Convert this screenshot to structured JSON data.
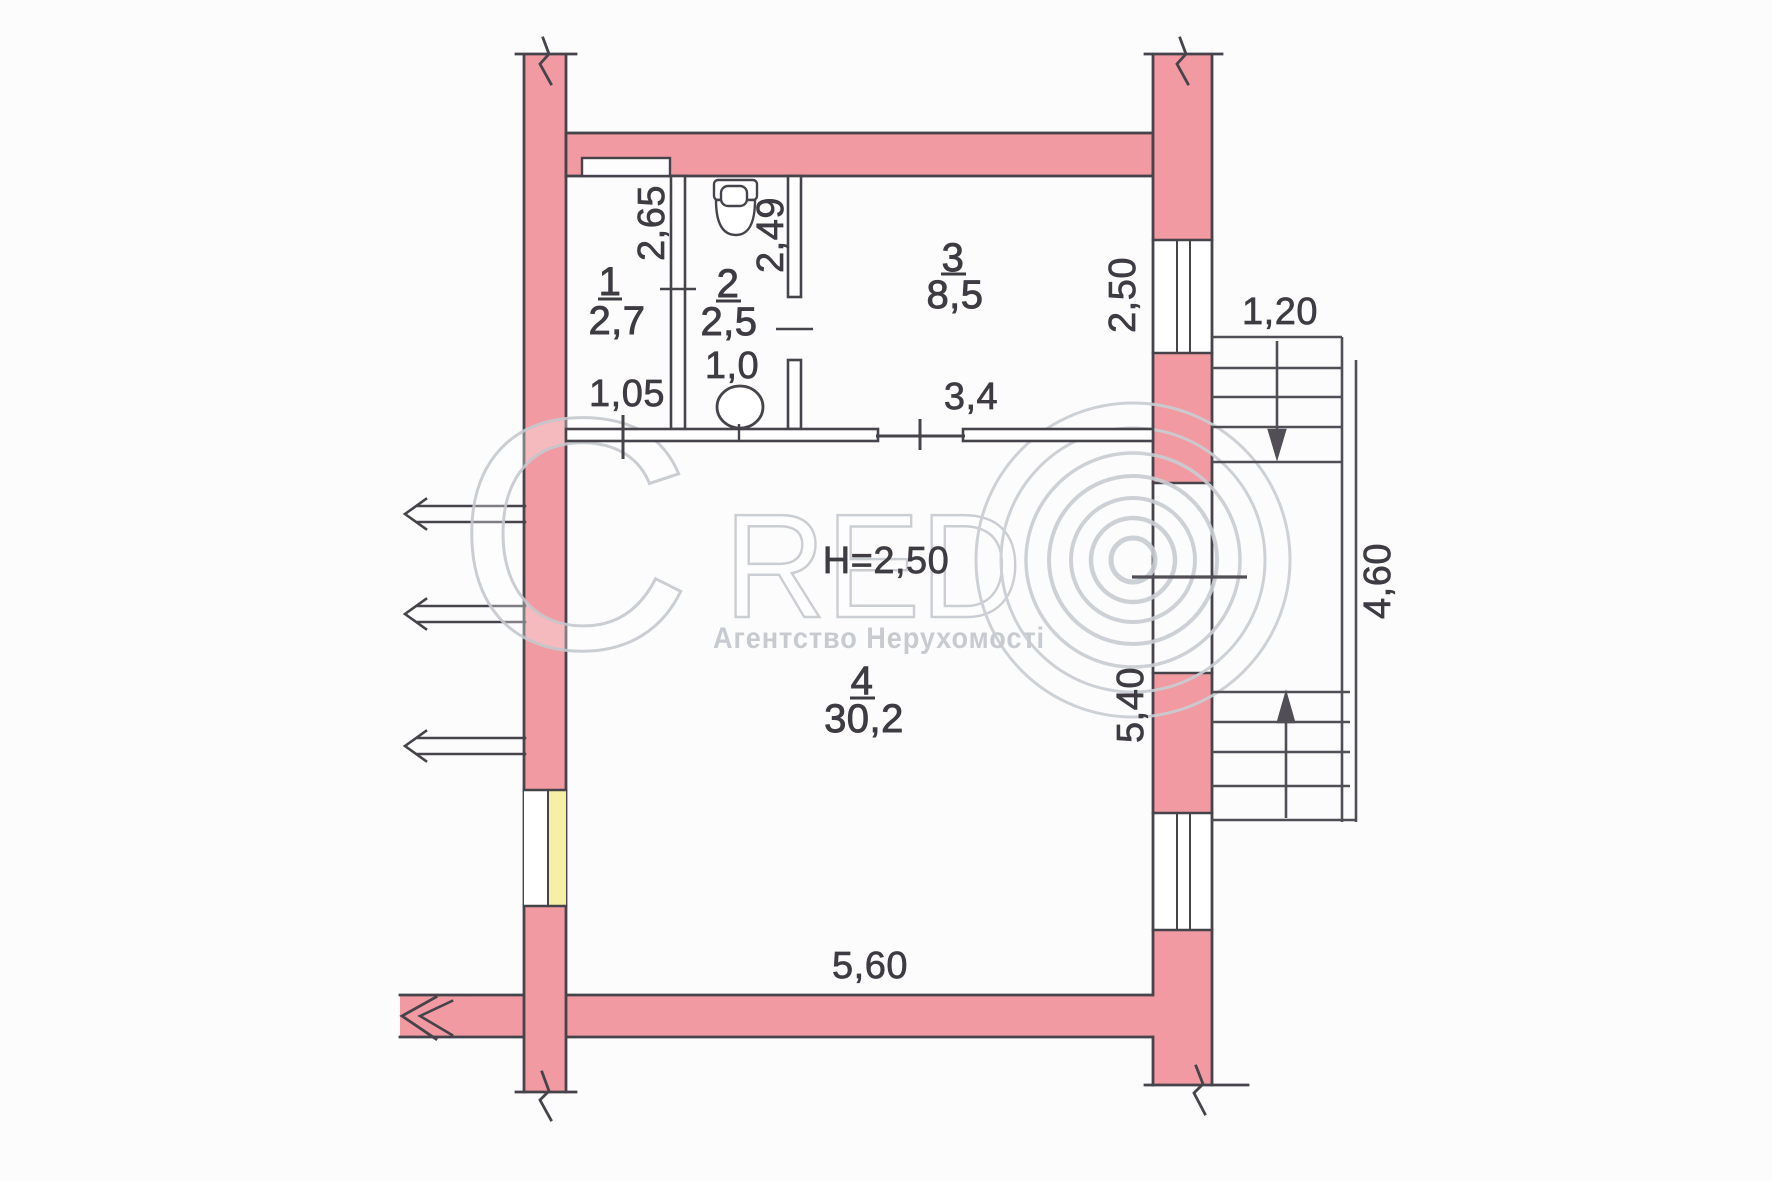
{
  "watermark": {
    "brand_initial": "C",
    "brand_rest": "RED",
    "subtitle": "Агентство Нерухомості"
  },
  "notes": {
    "ceiling_height": "H=2,50"
  },
  "rooms": [
    {
      "number": "1",
      "area": "2,7"
    },
    {
      "number": "2",
      "area": "2,5"
    },
    {
      "number": "3",
      "area": "8,5"
    },
    {
      "number": "4",
      "area": "30,2"
    }
  ],
  "dimensions": {
    "room1_depth": "2,65",
    "room1_width": "1,05",
    "room2_depth": "2,49",
    "room2_width": "1,0",
    "room3_depth": "2,50",
    "room3_width": "3,4",
    "room4_depth": "5,40",
    "room4_width": "5,60",
    "stairs_flight_width": "1,20",
    "stairs_depth": "4,60"
  },
  "colors": {
    "wall_fill": "#f19aa1",
    "window_accent": "#f6f0a6",
    "line": "#46434b",
    "watermark": "#c9cdd2"
  }
}
